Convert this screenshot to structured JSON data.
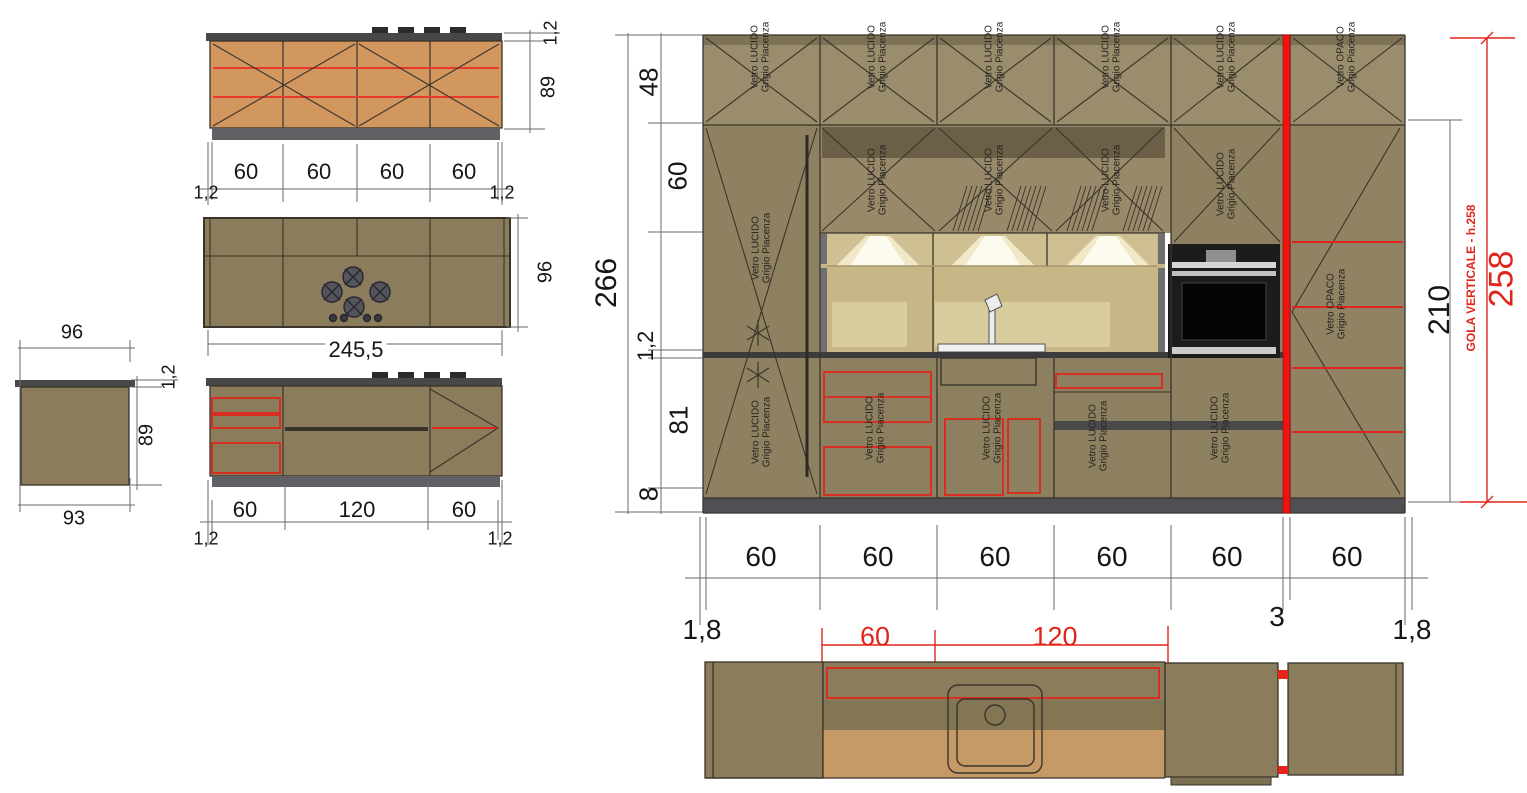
{
  "title": "Kitchen technical drawing - elevations and plans",
  "labels": {
    "vetro_lucido": "Vetro LUCIDO",
    "vetro_opaco": "Vetro OPACO",
    "grigio_piacenza": "Grigio Piacenza"
  },
  "dims": {
    "island_front": {
      "thickness_top": "1,2",
      "height": "89",
      "modules": [
        "60",
        "60",
        "60",
        "60"
      ],
      "edge_left": "1,2",
      "edge_right": "1,2"
    },
    "island_plan": {
      "width": "245,5",
      "depth": "96"
    },
    "island_back": {
      "modules": [
        "60",
        "120",
        "60"
      ],
      "edge_left": "1,2",
      "edge_right": "1,2"
    },
    "island_side": {
      "top_width": "96",
      "top_thickness": "1,2",
      "height": "89",
      "bottom_width": "93"
    },
    "elev_left": {
      "total": "266",
      "top_row": "48",
      "mid_row": "60",
      "counter": "1,2",
      "base": "81",
      "plinth": "8"
    },
    "elev_right": {
      "tall_height": "210",
      "gola_note": "GOLA VERTICALE - h.258",
      "gola_height": "258"
    },
    "elev_bottom": {
      "modules": [
        "60",
        "60",
        "60",
        "60",
        "60",
        "60"
      ],
      "edge_left": "1,8",
      "gola_gap": "3",
      "edge_right": "1,8",
      "red_module": "60",
      "red_span": "120"
    }
  },
  "colors": {
    "cabinet_olive": "#8d8060",
    "cabinet_olive_light": "#97896a",
    "island_orange": "#d1975f",
    "niche_tan": "#c7b787",
    "backsplash": "#d9cc9e",
    "counter_dark": "#3c3c3e",
    "plinth_gray": "#4f5054",
    "accent_red": "#e0261c",
    "gola_red": "#ee1411"
  }
}
